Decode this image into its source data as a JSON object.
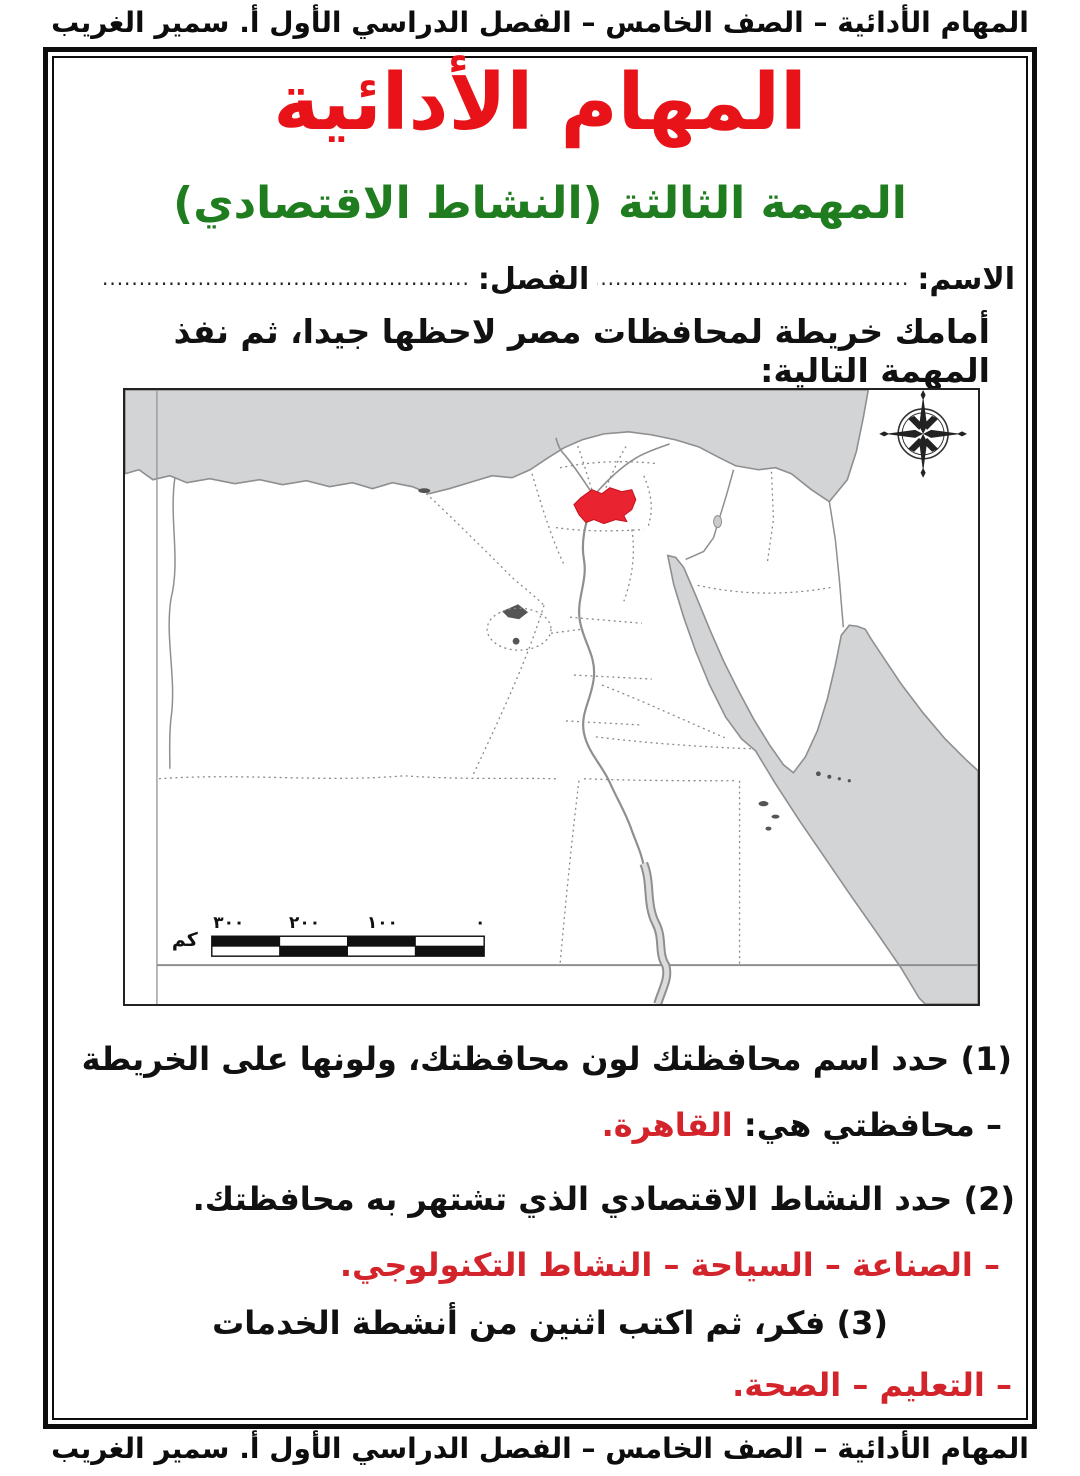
{
  "page": {
    "header": "المهام الأدائية – الصف الخامس – الفصل الدراسي الأول أ. سمير الغريب",
    "footer": "المهام الأدائية – الصف الخامس – الفصل الدراسي الأول أ. سمير الغريب"
  },
  "title": "المهام الأدائية",
  "subtitle": "المهمة الثالثة (النشاط الاقتصادي)",
  "form": {
    "name_label": "الاسم:",
    "name_dots": "..............................................",
    "class_label": "الفصل:",
    "class_dots": "...................................................."
  },
  "instruction": "أمامك خريطة لمحافظات مصر لاحظها جيدا، ثم نفذ المهمة التالية:",
  "map": {
    "highlighted_governorate": "القاهرة",
    "highlight_color": "#ea2330",
    "sea_color": "#d3d4d6",
    "scale_bar": {
      "labels": [
        "٣٠٠",
        "٢٠٠",
        "١٠٠",
        "٠"
      ],
      "unit": "كم"
    }
  },
  "questions": {
    "q1": "(1) حدد اسم محافظتك لون محافظتك، ولونها على الخريطة",
    "a1_label": "– محافظتي هي: ",
    "a1_value": "القاهرة.",
    "q2": "(2) حدد النشاط الاقتصادي الذي تشتهر به محافظتك.",
    "a2": "– الصناعة – السياحة – النشاط التكنولوجي.",
    "q3": "(3) فكر، ثم اكتب اثنين من أنشطة الخدمات",
    "a3": "– التعليم – الصحة."
  }
}
